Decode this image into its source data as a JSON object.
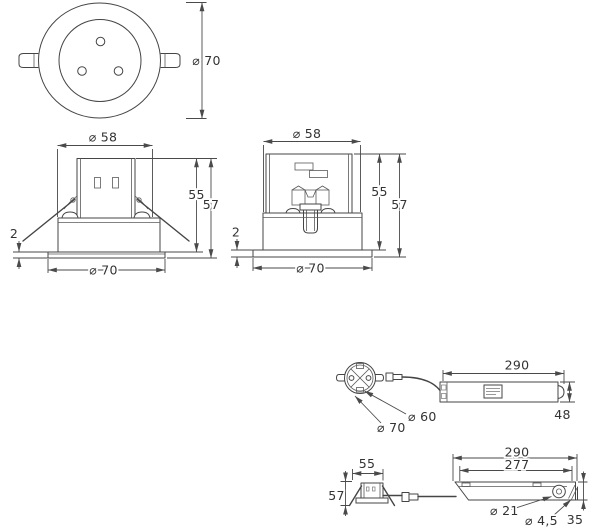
{
  "drawing_type": "dimension-drawing",
  "colors": {
    "line": "#454545",
    "dimension": "#4a4a4a",
    "text": "#333333",
    "background": "#ffffff"
  },
  "views": {
    "top": {
      "dia_bezel": "⌀ 70"
    },
    "front": {
      "dia_top": "⌀ 58",
      "height_body": "55",
      "height_total": "57",
      "flange_thickness": "2",
      "dia_bottom": "⌀ 70"
    },
    "side": {
      "dia_top": "⌀ 58",
      "height_body": "55",
      "height_total": "57",
      "flange_thickness": "2",
      "dia_bottom": "⌀ 70"
    },
    "driver_top": {
      "length": "290",
      "width": "48",
      "dia_cutout": "⌀ 60",
      "dia_bezel": "⌀ 70"
    },
    "driver_side": {
      "length": "290",
      "length_inner": "277",
      "housing_width": "55",
      "housing_height": "57",
      "dia_grommet": "⌀ 21",
      "dia_screw": "⌀ 4,5",
      "end_width": "35"
    }
  }
}
